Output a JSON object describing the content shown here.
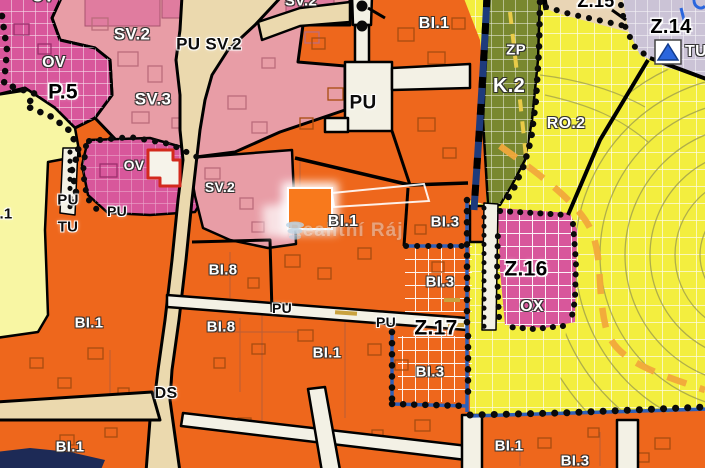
{
  "map": {
    "title": "zoning-plan-map",
    "watermark": {
      "text": "Realitní Ráj"
    },
    "icons": {
      "tu_marker": "blue-triangle-up-icon",
      "watermark_logo": "stacked-cup-icon"
    },
    "colors": {
      "orange": "#ee671c",
      "orange_bright": "#f8791c",
      "pink": "#e89da6",
      "pink_dark": "#e07c9f",
      "magenta": "#d8579b",
      "yellow": "#f3ee3f",
      "yellow_pale": "#f8f6a3",
      "olive": "#79882f",
      "lavender": "#cbc3d6",
      "beige": "#ebd9ae",
      "beige2": "#e9d5b5",
      "cream": "#f3f1e5",
      "navy": "#1e3b7c",
      "blue": "#2e5fb8",
      "blue_tri": "#2b66dd",
      "red": "#d3291d",
      "dash_orange": "#f1a83b",
      "dash_yellow": "#e9cb48",
      "contour": "#99994d"
    },
    "labels": {
      "ov_top_cut": "OV",
      "ov": "OV",
      "p5": "P.5",
      "sv2_main": "SV.2",
      "pu_sv2": "PU SV.2",
      "sv2_top": "SV.2",
      "sv3": "SV.3",
      "sv2_mid": "SV.2",
      "ov2": "OV",
      "pu_left": "PU",
      "tu_left": "TU",
      "dot1": ".1",
      "pu_small": "PU",
      "pu_center": "PU",
      "bi1_top": "BI.1",
      "zp": "ZP",
      "k2": "K.2",
      "ro2": "RO.2",
      "z15": "Z.15",
      "z14": "Z.14",
      "tu_right": "TU",
      "bi8_a": "BI.8",
      "bi1_left": "BI.1",
      "bi8_b": "BI.8",
      "bi1_center": "BI.1",
      "bi3_a": "BI.3",
      "bi3_b": "BI.3",
      "z16": "Z.16",
      "ox": "OX",
      "pu_r1": "PU",
      "pu_r2": "PU",
      "z17": "Z.17",
      "bi1_mid": "BI.1",
      "ds": "DS",
      "bi1_bl": "BI.1",
      "bi1_br": "BI.1",
      "bi3_c": "BI.3",
      "bi3_d": "BI.3"
    }
  }
}
